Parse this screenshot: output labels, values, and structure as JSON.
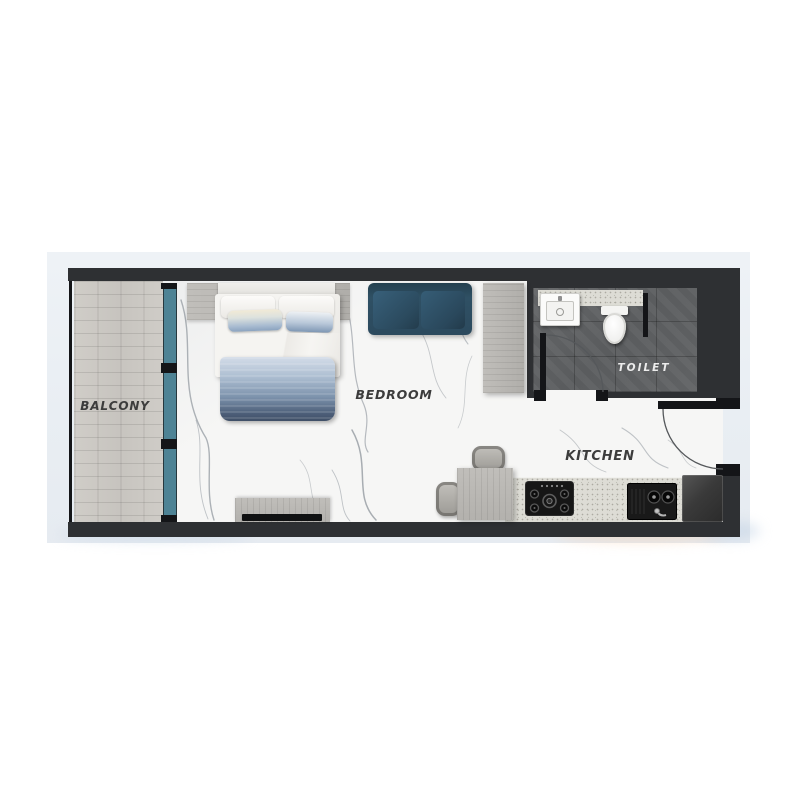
{
  "plan": {
    "type": "studio-apartment-floor-plan",
    "rooms": {
      "balcony": {
        "label": "BALCONY"
      },
      "bedroom": {
        "label": "BEDROOM"
      },
      "kitchen": {
        "label": "KITCHEN"
      },
      "toilet": {
        "label": "TOILET"
      }
    },
    "furniture": [
      "double-bed",
      "sofa",
      "wardrobe",
      "closet-strip",
      "tv-console",
      "tv",
      "dining-table",
      "dining-chair",
      "dining-chair",
      "kitchen-counter",
      "cooktop",
      "kitchen-sink",
      "fridge",
      "bathroom-counter",
      "bathroom-sink",
      "toilet-wc",
      "glass-sliding-door",
      "entrance-door",
      "toilet-door",
      "balcony-railing"
    ],
    "palette": {
      "wall": "#2e3033",
      "card_background": "#e9eef3",
      "marble_floor": "#f6f6f5",
      "balcony_wood": "#cbc8c3",
      "glass_teal": "#4e8395",
      "sofa_blue": "#2f4f63",
      "toilet_tile": "#5d5f61",
      "counter_speckle": "#dddcd5",
      "furniture_gray": "#b7b5b1",
      "quilt_blue_dark": "#46546e",
      "quilt_blue_light": "#d3dce8"
    }
  }
}
